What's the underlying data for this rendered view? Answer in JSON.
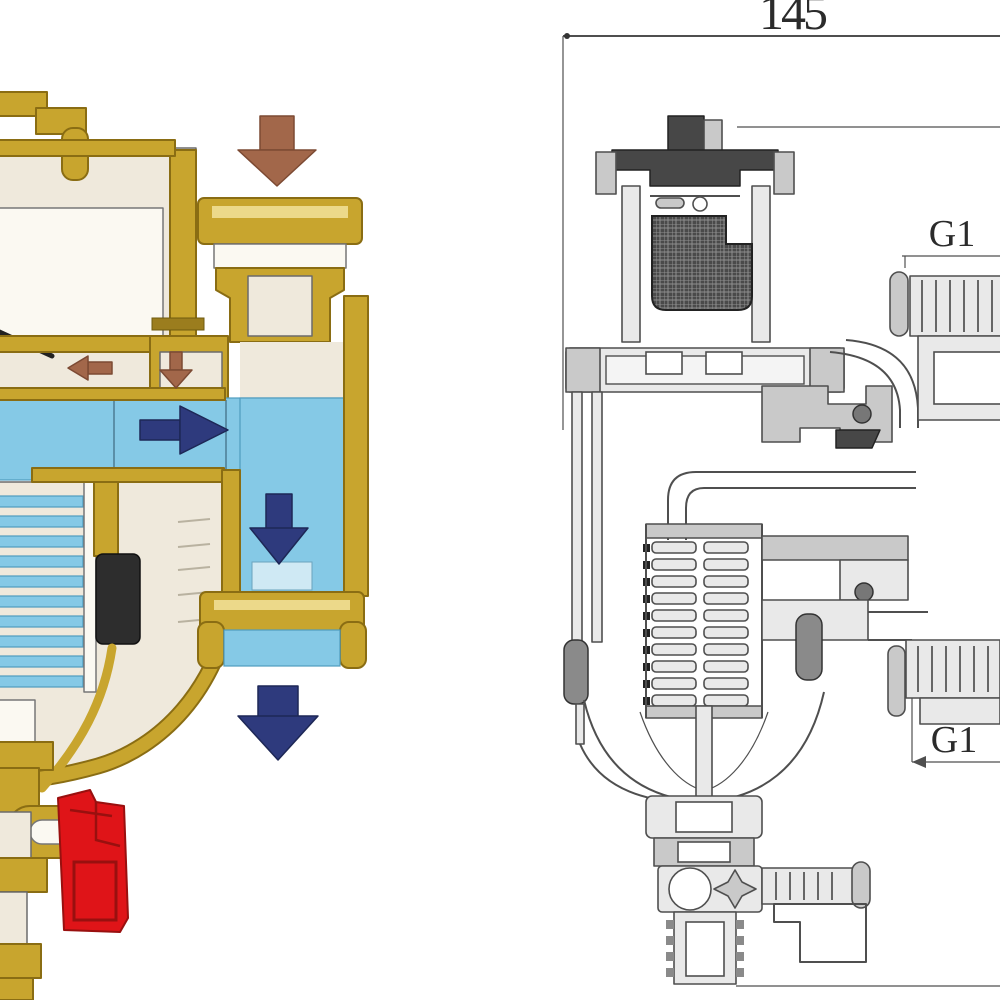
{
  "colors": {
    "background": "#ffffff",
    "brass": "#c8a52e",
    "brass_dark": "#8a6d13",
    "brass_light": "#ecd98a",
    "cream": "#efe9dc",
    "water_blue": "#85c9e6",
    "water_blue_dark": "#4f9cbf",
    "arrow_navy": "#2e3a7d",
    "arrow_brown": "#a2674a",
    "magnet_black": "#2d2d2d",
    "handle_red": "#df1418",
    "handle_red_dark": "#99100f",
    "line_gray": "#4f4f4f",
    "fill_gray_light": "#e9e9e9",
    "fill_gray_mid": "#c9c9c9",
    "fill_gray_dark": "#8a8a8a"
  },
  "left_illustration": {
    "name": "valve-cutaway-color-illustration",
    "arrows": [
      {
        "name": "inlet-flow-arrow",
        "direction": "down",
        "color": "#a2674a"
      },
      {
        "name": "air-bubble-arrow-left",
        "direction": "left",
        "color": "#a2674a"
      },
      {
        "name": "air-bubble-arrow-down",
        "direction": "down",
        "color": "#a2674a"
      },
      {
        "name": "water-flow-arrow-right",
        "direction": "right",
        "color": "#2e3a7d"
      },
      {
        "name": "water-flow-arrow-down-channel",
        "direction": "down",
        "color": "#2e3a7d"
      },
      {
        "name": "outlet-flow-arrow",
        "direction": "down",
        "color": "#2e3a7d"
      }
    ]
  },
  "right_drawing": {
    "name": "valve-technical-section-drawing",
    "overall_dimension_label": "145",
    "upper_port_label": "G1",
    "lower_port_label": "G1"
  }
}
